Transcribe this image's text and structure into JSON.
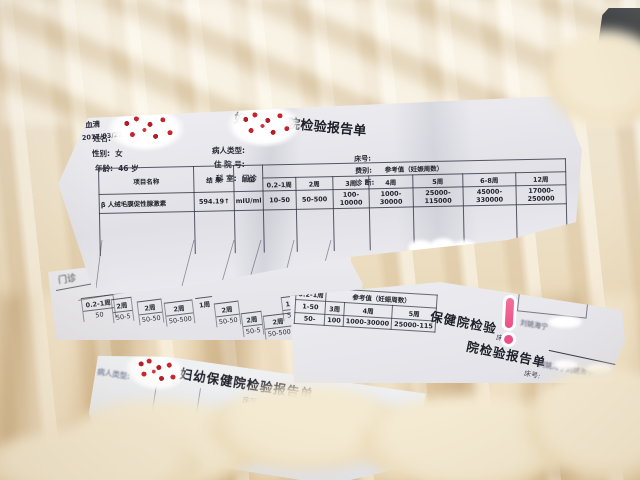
{
  "colors": {
    "blanket": "#eee0c4",
    "paper": "#e9e9ee",
    "ink": "#2c2c38",
    "cherry_red": "#c8242c",
    "sticker_pink": "#ec4f86",
    "dark_object": "#2e3134"
  },
  "report_top": {
    "title": "妇幼保健院检验报告单",
    "fields": {
      "name_label": "姓名:",
      "gender_label": "性别:",
      "gender_value": "女",
      "age_label": "年龄:",
      "age_value": "46 岁",
      "type_label": "病人类型:",
      "inpatient_label": "住 院 号:",
      "dept_label": "科 室:",
      "dept_value": "门诊",
      "bed_label": "床号:",
      "fee_label": "费别:",
      "diag_label": "诊 断:",
      "sample_no_label": "标本号:",
      "sample_no_value": "1",
      "sample_type_label": "标本类型:",
      "sample_type_value": "血清",
      "time_label": "送检时间:",
      "time_value": "2017/03/22 06:00",
      "note_label": "备 注:"
    },
    "table": {
      "item_col": "项目名称",
      "result_col": "结 果",
      "unit_col": "单位",
      "ref_group": "参考值（妊娠周数）",
      "weeks": [
        "0.2-1周",
        "2周",
        "3周",
        "4周",
        "5周",
        "6-8周",
        "12周"
      ],
      "item": "β 人绒毛膜促性腺激素",
      "result": "594.19↑",
      "unit": "mIU/ml",
      "refs": [
        "10-50",
        "50-500",
        "100-10000",
        "1000-30000",
        "25000-115000",
        "45000-330000",
        "17000-250000"
      ]
    },
    "censor_text": "海宁"
  },
  "band_extra": {
    "dept_stamp": "门诊"
  },
  "stack_fragments": [
    {
      "w": "0.2-1周",
      "v": "50"
    },
    {
      "w": "2周",
      "v": "50-5"
    },
    {
      "w": "2周",
      "v": "50-50"
    },
    {
      "w": "2周",
      "v": "50-500"
    },
    {
      "w": "1周",
      "v": ""
    },
    {
      "w": "2周",
      "v": "50-50"
    },
    {
      "w": "2周",
      "v": "50-5"
    },
    {
      "w": "2周",
      "v": "50-500"
    },
    {
      "w": "1周",
      "v": "50-"
    }
  ],
  "report_mid": {
    "ref_group": "参考值（妊娠周数）",
    "left_week": "0.2-1周",
    "left_vals": [
      "1-50",
      "50-"
    ],
    "weeks": [
      "3周",
      "4周",
      "5周"
    ],
    "vals": [
      "100",
      "1000-30000",
      "25000-115"
    ],
    "hospital_fragment": "保健院检验",
    "report_fragment": "院检验报告单",
    "names1": "刘姚海宁",
    "names2": "刘姚海宁刘姚海宁",
    "bed_label": "床号:",
    "bed_label2": "床号:"
  },
  "report_bottom": {
    "title": "妇幼保健院检验报告单",
    "type_label": "病人类型:",
    "bed_label": "床号:",
    "fee_label": "费别:",
    "frag": {
      "w": "2-1周",
      "v": "50"
    }
  }
}
